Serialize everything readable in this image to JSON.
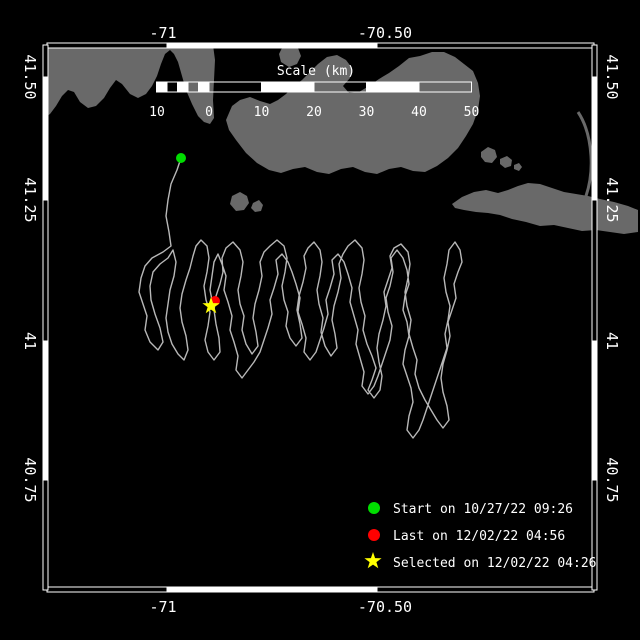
{
  "colors": {
    "background": "#000000",
    "frame": "#ffffff",
    "land": "#696969",
    "track": "#b8b8b8",
    "start_marker": "#00dd00",
    "last_marker": "#ff0000",
    "selected_marker": "#ffff00"
  },
  "axes": {
    "top": [
      "-71",
      "-70.50"
    ],
    "bottom": [
      "-71",
      "-70.50"
    ],
    "left": [
      "41.50",
      "41.25",
      "41",
      "40.75"
    ],
    "right": [
      "41.50",
      "41.25",
      "41",
      "40.75"
    ]
  },
  "scale_bar": {
    "title": "Scale (km)",
    "ticks": [
      "10",
      "0",
      "10",
      "20",
      "30",
      "40",
      "50"
    ]
  },
  "legend": {
    "items": [
      {
        "marker": "circle",
        "color": "#00dd00",
        "label": "Start on 10/27/22 09:26"
      },
      {
        "marker": "circle",
        "color": "#ff0000",
        "label": "Last on 12/02/22 04:56"
      },
      {
        "marker": "star",
        "color": "#ffff00",
        "label": "Selected on 12/02/22 04:26"
      }
    ]
  },
  "map": {
    "land_color": "#696969",
    "track_color": "#b8b8b8",
    "land": {
      "mainland": "M47,45 L213,45 L215,60 L214,80 L213,100 L214,118 L210,124 L204,122 L198,116 L192,104 L186,90 L182,76 L178,62 L174,54 L170,50 L165,54 L161,64 L157,76 L152,86 L146,94 L138,98 L130,94 L122,84 L116,80 L110,88 L104,98 L96,106 L88,108 L80,102 L74,92 L68,90 L62,96 L56,106 L50,114 L47,116 Z",
      "small_island": "M282,48 L291,44 L298,48 L301,56 L297,64 L289,67 L281,62 L279,54 Z",
      "cape_cod": "M226,120 L232,106 L240,100 L250,97 L260,101 L270,104 L278,100 L286,94 L294,86 L302,80 L310,72 L318,64 L327,57 L337,55 L346,60 L352,68 L350,78 L343,86 L349,93 L359,92 L369,86 L379,79 L389,73 L399,66 L409,58 L420,56 L432,52 L444,52 L455,57 L464,64 L473,71 L478,83 L480,96 L478,110 L473,124 L466,136 L458,148 L448,158 L437,166 L425,172 L413,171 L401,167 L389,169 L377,174 L365,172 L353,167 L341,169 L329,174 L317,172 L305,167 L293,169 L281,173 L269,170 L257,163 L246,153 L236,140 L229,130 Z",
      "nantucket": "M452,204 L462,197 L474,192 L486,190 L498,193 L508,190 L518,186 L528,183 L540,184 L552,188 L564,192 L576,194 L588,196 L600,199 L614,202 L628,206 L638,210 L638,232 L624,234 L610,232 L596,230 L582,231 L568,228 L554,225 L540,226 L526,222 L512,219 L500,215 L488,213 L476,212 L464,210 L455,208 Z",
      "small_islands": "M481,152 L488,147 L495,150 L497,157 L492,163 L485,162 L481,157 Z M500,159 L507,156 L512,160 L511,166 L505,168 L500,164 Z M514,165 L519,163 L522,167 L519,171 L514,169 Z M232,196 L240,192 L247,196 L249,203 L244,210 L236,211 L230,204 Z M253,203 L259,200 L263,205 L261,211 L255,212 L251,208 Z",
      "outer_beach": "M578,112 C586,124 590,140 591,156 C592,172 590,184 586,196"
    },
    "track_path": "M181,158 L177,170 L171,184 L168,200 L166,216 L169,232 L171,246 L163,252 L152,258 L145,266 L141,278 L139,292 L143,304 L147,316 L145,330 L150,342 L158,350 L163,342 L160,328 L155,314 L151,300 L150,286 L153,272 L160,264 L168,258 L173,250 L176,262 L174,276 L170,290 L168,304 L166,318 L168,332 L172,344 L178,354 L184,360 L188,350 L186,336 L182,322 L180,308 L182,294 L186,280 L190,268 L193,256 L196,246 L201,240 L207,246 L209,258 L207,272 L204,286 L206,300 L210,312 L208,326 L205,340 L208,352 L214,360 L220,352 L219,338 L216,324 L214,310 L216,296 L220,284 L223,272 L222,258 L226,248 L233,242 L240,250 L243,262 L241,276 L238,290 L240,304 L244,316 L242,330 L246,344 L252,354 L258,346 L256,332 L253,318 L255,304 L259,290 L262,276 L260,262 L264,252 L270,246 L277,240 L284,246 L287,258 L285,272 L282,286 L284,300 L288,312 L286,326 L290,338 L296,346 L302,338 L300,324 L297,310 L299,296 L303,282 L306,268 L304,256 L308,248 L314,242 L320,250 L322,262 L320,276 L317,290 L319,304 L323,318 L321,332 L325,346 L331,356 L337,348 L335,334 L332,320 L334,306 L338,292 L341,278 L339,264 L343,254 L348,246 L355,240 L362,248 L364,260 L362,274 L359,288 L361,302 L365,316 L363,330 L367,344 L372,356 L376,368 L372,380 L368,390 L374,398 L380,390 L382,376 L379,362 L377,348 L379,334 L383,320 L386,306 L384,292 L388,280 L392,268 L390,256 L394,248 L401,244 L408,252 L410,264 L408,278 L405,292 L407,306 L411,320 L409,334 L413,348 L417,360 L415,374 L419,388 L425,400 L431,410 L437,420 L443,428 L449,420 L447,406 L443,392 L441,378 L443,364 L447,350 L450,336 L448,322 L452,310 L456,298 L454,284 L458,272 L462,262 L460,250 L455,242 L449,250 L447,264 L444,278 L446,292 L450,306 L448,320 L445,334 L447,348 L443,360 L439,372 L435,384 L431,396 L427,408 L423,420 L419,430 L413,438 L407,430 L409,416 L413,402 L411,388 L407,376 L403,364 L405,350 L409,336 L407,322 L403,310 L405,296 L409,284 L407,270 L403,258 L397,250 L391,258 L393,272 L390,286 L386,298 L388,312 L392,326 L390,340 L386,352 L382,364 L378,376 L374,386 L368,394 L362,386 L364,372 L360,358 L356,344 L358,330 L354,316 L350,302 L352,288 L348,274 L344,262 L338,254 L332,260 L334,274 L330,288 L326,300 L328,314 L324,328 L320,340 L316,352 L310,360 L304,352 L306,338 L302,324 L298,312 L300,298 L296,284 L292,272 L288,262 L282,254 L276,260 L278,274 L274,288 L270,300 L272,314 L268,328 L264,340 L260,352 L254,362 L248,370 L242,378 L236,370 L238,356 L234,342 L230,330 L232,316 L228,302 L224,290 L226,276 L222,264 L218,254 L214,262 L212,276 L210,290 L212,300 L214,303",
    "markers": {
      "start": {
        "x": 181,
        "y": 158
      },
      "last": {
        "x": 215,
        "y": 301
      },
      "selected": {
        "x": 211,
        "y": 306
      }
    }
  }
}
